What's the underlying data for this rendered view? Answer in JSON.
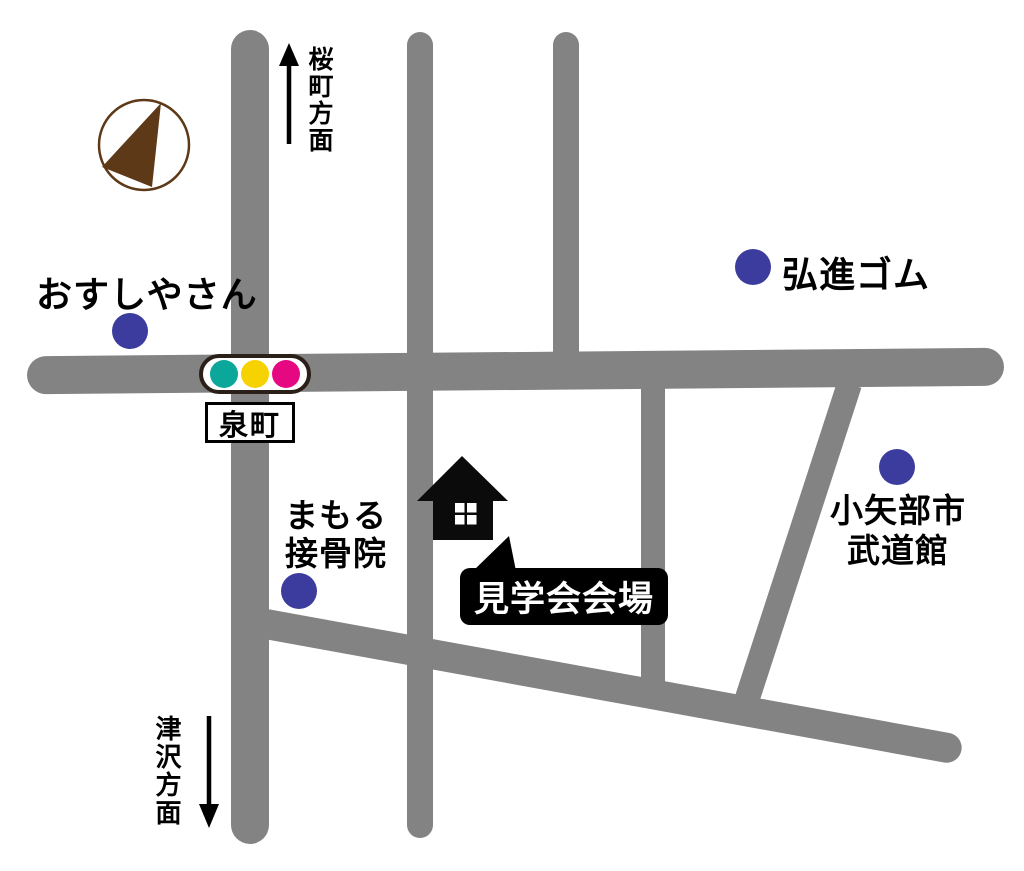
{
  "map": {
    "type": "access-map",
    "venue": {
      "label": "見学会会場"
    },
    "intersection": {
      "name": "泉町"
    },
    "directions": {
      "north": {
        "label": "桜町方面"
      },
      "south": {
        "label": "津沢方面"
      }
    },
    "landmarks": [
      {
        "name": "おすしやさん"
      },
      {
        "name": "弘進ゴム"
      },
      {
        "name": "まもる\n接骨院"
      },
      {
        "name": "小矢部市\n武道館"
      }
    ],
    "traffic_light": {
      "lamp_colors": [
        "#0ca79b",
        "#f6d200",
        "#e50880"
      ],
      "border_color": "#2a2019"
    },
    "colors": {
      "road": "#838383",
      "landmark_dot": "#3b3c9e",
      "compass_brown": "#5d3917",
      "venue_box": "#000000",
      "venue_text": "#ffffff"
    }
  }
}
